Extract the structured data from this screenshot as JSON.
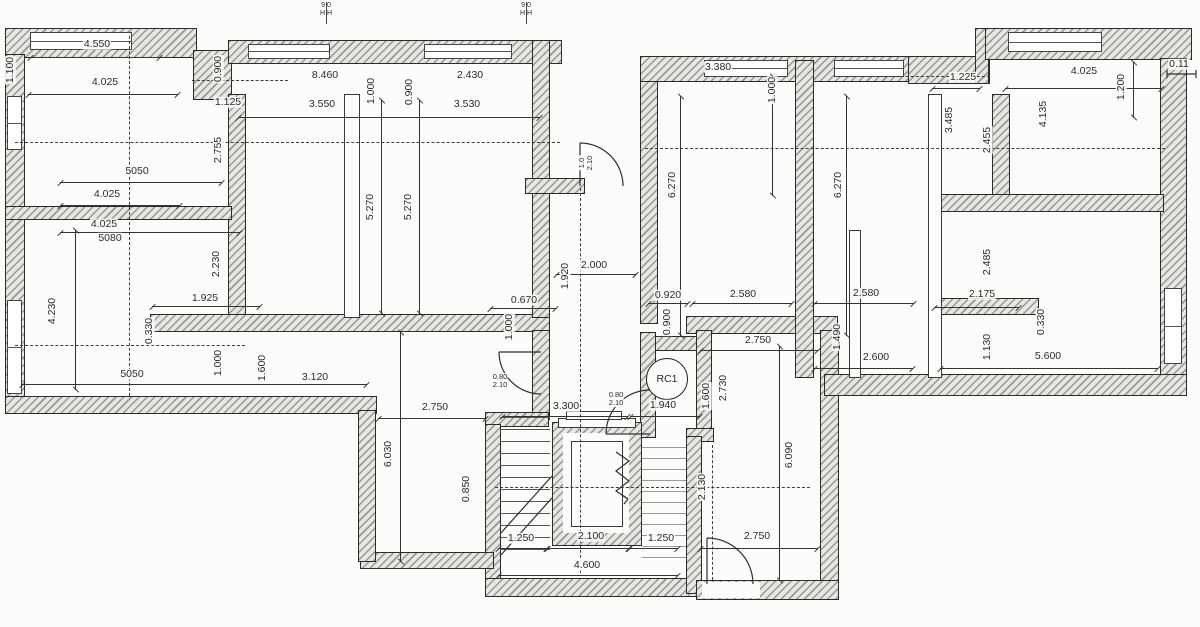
{
  "drawing": {
    "kind": "architectural floor plan with stair and elevator core",
    "rc1_label": "RC1",
    "offset_label": "0.11"
  },
  "colors": {
    "paper": "#fcfcfa",
    "ink": "#2b2b2b",
    "hatch": "#98988f"
  },
  "labels": [
    {
      "t": "4.550",
      "x": 97,
      "y": 44,
      "r": 0
    },
    {
      "t": "4.025",
      "x": 105,
      "y": 82,
      "r": 0
    },
    {
      "t": "1.125",
      "x": 228,
      "y": 102,
      "r": 0
    },
    {
      "t": "8.460",
      "x": 325,
      "y": 75,
      "r": 0
    },
    {
      "t": "3.550",
      "x": 322,
      "y": 104,
      "r": 0
    },
    {
      "t": "2.430",
      "x": 470,
      "y": 75,
      "r": 0
    },
    {
      "t": "3.530",
      "x": 467,
      "y": 104,
      "r": 0
    },
    {
      "t": "3.380",
      "x": 718,
      "y": 67,
      "r": 0
    },
    {
      "t": "1.225",
      "x": 963,
      "y": 77,
      "r": 0
    },
    {
      "t": "4.025",
      "x": 1084,
      "y": 71,
      "r": 0
    },
    {
      "t": "0.11",
      "x": 1179,
      "y": 64,
      "r": 0
    },
    {
      "t": "5050",
      "x": 137,
      "y": 171,
      "r": 0
    },
    {
      "t": "4.025",
      "x": 107,
      "y": 194,
      "r": 0
    },
    {
      "t": "4.025",
      "x": 104,
      "y": 224,
      "r": 0
    },
    {
      "t": "5080",
      "x": 110,
      "y": 238,
      "r": 0
    },
    {
      "t": "1.925",
      "x": 205,
      "y": 298,
      "r": 0
    },
    {
      "t": "0.670",
      "x": 524,
      "y": 300,
      "r": 0
    },
    {
      "t": "2.000",
      "x": 594,
      "y": 265,
      "r": 0
    },
    {
      "t": "0.920",
      "x": 668,
      "y": 295,
      "r": 0
    },
    {
      "t": "2.580",
      "x": 743,
      "y": 294,
      "r": 0
    },
    {
      "t": "2.580",
      "x": 866,
      "y": 293,
      "r": 0
    },
    {
      "t": "2.175",
      "x": 982,
      "y": 294,
      "r": 0
    },
    {
      "t": "2.750",
      "x": 758,
      "y": 340,
      "r": 0
    },
    {
      "t": "2.600",
      "x": 876,
      "y": 357,
      "r": 0
    },
    {
      "t": "5.600",
      "x": 1048,
      "y": 356,
      "r": 0
    },
    {
      "t": "5050",
      "x": 132,
      "y": 374,
      "r": 0
    },
    {
      "t": "3.120",
      "x": 315,
      "y": 377,
      "r": 0
    },
    {
      "t": "2.750",
      "x": 435,
      "y": 407,
      "r": 0
    },
    {
      "t": "3.300",
      "x": 566,
      "y": 406,
      "r": 0
    },
    {
      "t": "1.940",
      "x": 663,
      "y": 405,
      "r": 0
    },
    {
      "t": "1.250",
      "x": 521,
      "y": 538,
      "r": 0
    },
    {
      "t": "2.100",
      "x": 591,
      "y": 536,
      "r": 0
    },
    {
      "t": "1.250",
      "x": 661,
      "y": 538,
      "r": 0
    },
    {
      "t": "4.600",
      "x": 587,
      "y": 565,
      "r": 0
    },
    {
      "t": "2.750",
      "x": 757,
      "y": 536,
      "r": 0
    },
    {
      "t": "1.100",
      "x": 10,
      "y": 70,
      "r": 1
    },
    {
      "t": "0.900",
      "x": 218,
      "y": 69,
      "r": 1
    },
    {
      "t": "2.755",
      "x": 218,
      "y": 150,
      "r": 1
    },
    {
      "t": "1.000",
      "x": 371,
      "y": 91,
      "r": 1
    },
    {
      "t": "0.900",
      "x": 409,
      "y": 92,
      "r": 1
    },
    {
      "t": "5.270",
      "x": 370,
      "y": 207,
      "r": 1
    },
    {
      "t": "5.270",
      "x": 408,
      "y": 207,
      "r": 1
    },
    {
      "t": "1.000",
      "x": 772,
      "y": 90,
      "r": 1
    },
    {
      "t": "6.270",
      "x": 672,
      "y": 185,
      "r": 1
    },
    {
      "t": "6.270",
      "x": 838,
      "y": 185,
      "r": 1
    },
    {
      "t": "1.200",
      "x": 1121,
      "y": 87,
      "r": 1
    },
    {
      "t": "3.485",
      "x": 949,
      "y": 120,
      "r": 1
    },
    {
      "t": "2.455",
      "x": 987,
      "y": 140,
      "r": 1
    },
    {
      "t": "4.135",
      "x": 1043,
      "y": 114,
      "r": 1
    },
    {
      "t": "2.230",
      "x": 216,
      "y": 264,
      "r": 1
    },
    {
      "t": "4.230",
      "x": 52,
      "y": 311,
      "r": 1
    },
    {
      "t": "0.330",
      "x": 149,
      "y": 331,
      "r": 1
    },
    {
      "t": "1.920",
      "x": 565,
      "y": 276,
      "r": 1
    },
    {
      "t": "1.000",
      "x": 509,
      "y": 327,
      "r": 1
    },
    {
      "t": "0.900",
      "x": 667,
      "y": 322,
      "r": 1
    },
    {
      "t": "1.490",
      "x": 837,
      "y": 337,
      "r": 1
    },
    {
      "t": "2.485",
      "x": 987,
      "y": 262,
      "r": 1
    },
    {
      "t": "0.330",
      "x": 1041,
      "y": 322,
      "r": 1
    },
    {
      "t": "1.130",
      "x": 987,
      "y": 347,
      "r": 1
    },
    {
      "t": "1.000",
      "x": 218,
      "y": 363,
      "r": 1
    },
    {
      "t": "1.600",
      "x": 262,
      "y": 368,
      "r": 1
    },
    {
      "t": "1.600",
      "x": 706,
      "y": 396,
      "r": 1
    },
    {
      "t": "2.730",
      "x": 723,
      "y": 388,
      "r": 1
    },
    {
      "t": "6.030",
      "x": 388,
      "y": 454,
      "r": 1
    },
    {
      "t": "0.850",
      "x": 466,
      "y": 489,
      "r": 1
    },
    {
      "t": "2.130",
      "x": 702,
      "y": 487,
      "r": 1
    },
    {
      "t": "6.090",
      "x": 789,
      "y": 455,
      "r": 1
    }
  ],
  "door_tags": [
    {
      "t": "0.80\n2.10",
      "x": 500,
      "y": 381,
      "r": 0
    },
    {
      "t": "0.80\n2.10",
      "x": 616,
      "y": 399,
      "r": 0
    },
    {
      "t": "1.0\n2.10",
      "x": 586,
      "y": 163,
      "r": 1
    }
  ],
  "window_markers": [
    {
      "t": "9 0\nH H",
      "x": 326,
      "y": 2
    },
    {
      "t": "9 0\nH H",
      "x": 526,
      "y": 2
    }
  ]
}
